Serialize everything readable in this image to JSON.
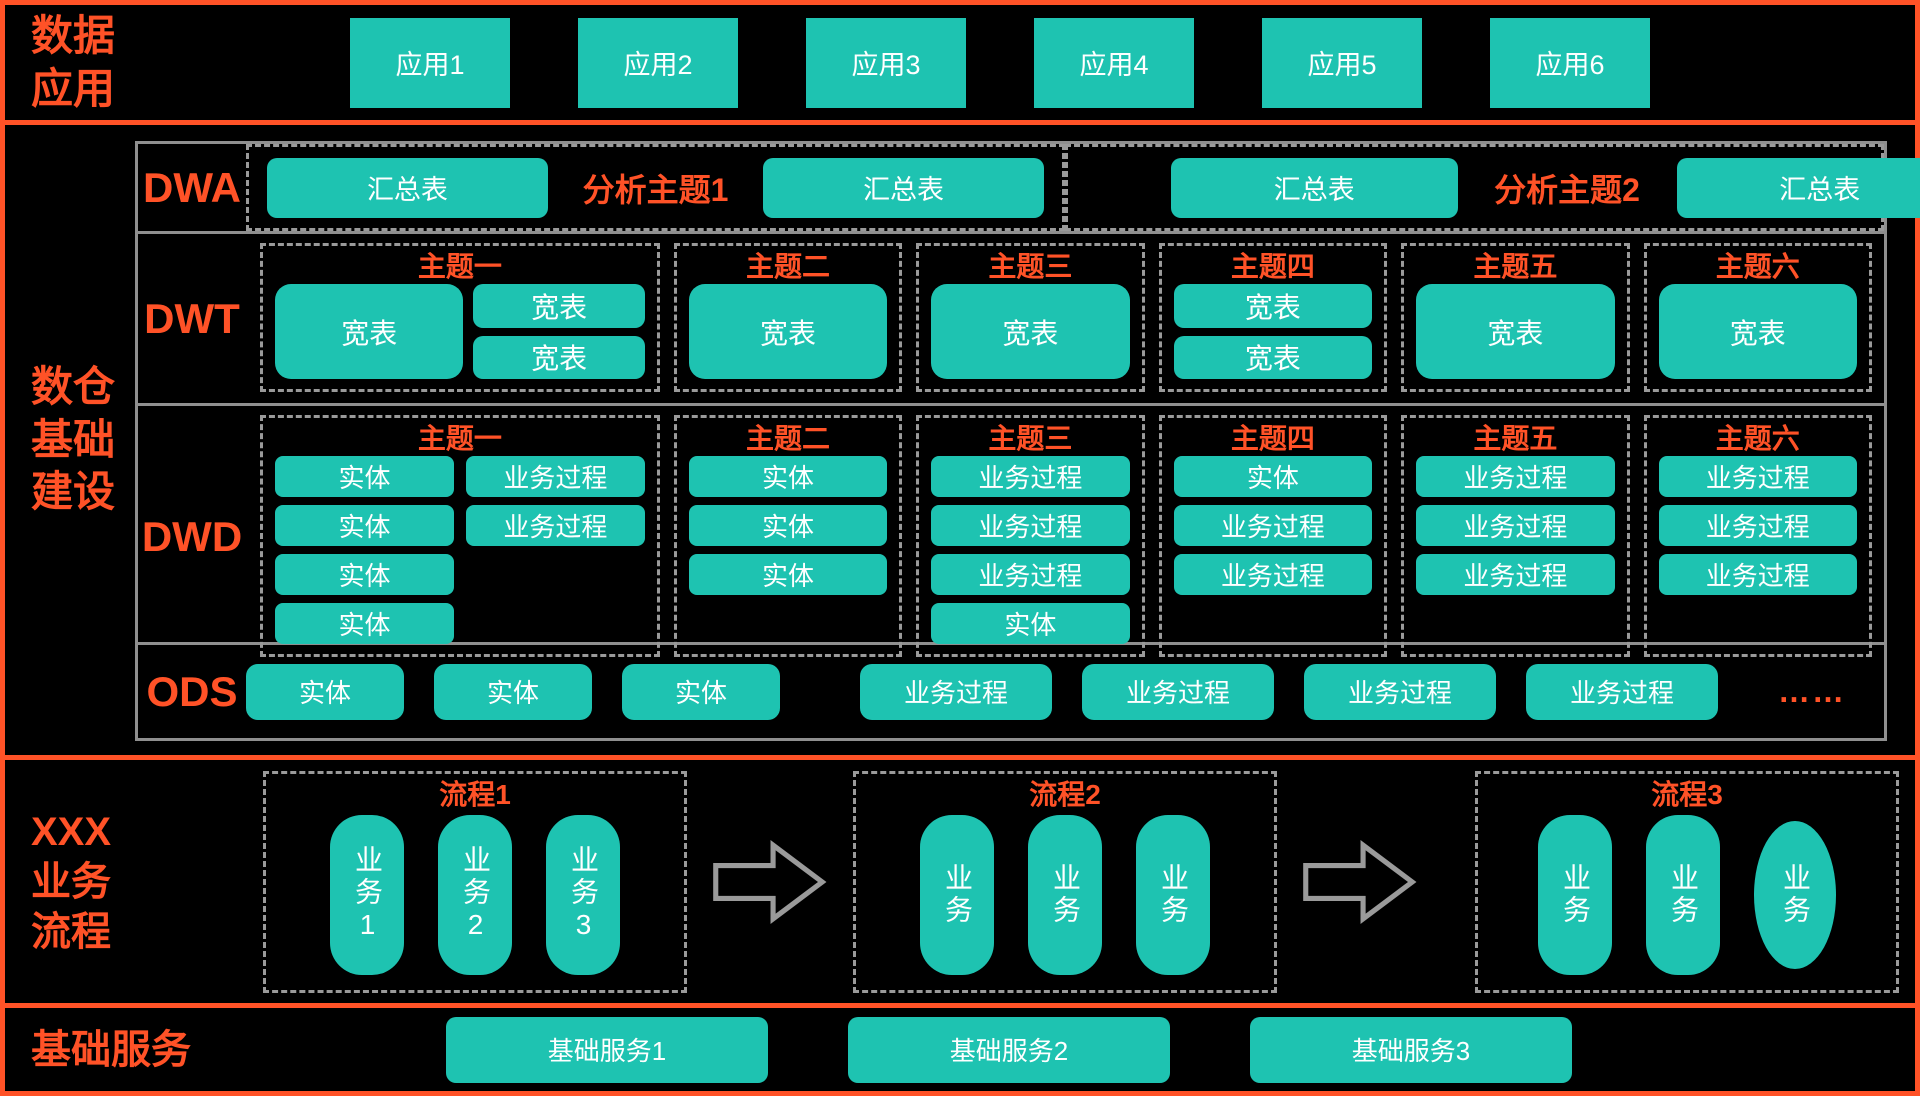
{
  "colors": {
    "accent": "#FF5227",
    "teal": "#1EC3B1",
    "dashed_gray": "#9A9A9A",
    "solid_gray": "#8F8F8F",
    "box_text": "#FFFFFF",
    "background": "#000000"
  },
  "apps_section": {
    "label": "数据\n应用",
    "apps": [
      "应用1",
      "应用2",
      "应用3",
      "应用4",
      "应用5",
      "应用6"
    ]
  },
  "warehouse_section": {
    "label": "数仓\n基础\n建设",
    "dwa": {
      "label": "DWA",
      "groups": [
        {
          "title": "分析主题1",
          "boxes": [
            "汇总表",
            "汇总表"
          ]
        },
        {
          "title": "分析主题2",
          "boxes": [
            "汇总表",
            "汇总表"
          ]
        }
      ]
    },
    "dwt": {
      "label": "DWT",
      "themes": [
        {
          "title": "主题一",
          "big_box": "宽表",
          "stack": [
            "宽表",
            "宽表"
          ]
        },
        {
          "title": "主题二",
          "boxes": [
            "宽表"
          ]
        },
        {
          "title": "主题三",
          "boxes": [
            "宽表"
          ]
        },
        {
          "title": "主题四",
          "boxes": [
            "宽表",
            "宽表"
          ]
        },
        {
          "title": "主题五",
          "boxes": [
            "宽表"
          ]
        },
        {
          "title": "主题六",
          "boxes": [
            "宽表"
          ]
        }
      ]
    },
    "dwd": {
      "label": "DWD",
      "themes": [
        {
          "title": "主题一",
          "col1": [
            "实体",
            "实体",
            "实体",
            "实体"
          ],
          "col2": [
            "业务过程",
            "业务过程"
          ]
        },
        {
          "title": "主题二",
          "boxes": [
            "实体",
            "实体",
            "实体"
          ]
        },
        {
          "title": "主题三",
          "boxes": [
            "业务过程",
            "业务过程",
            "业务过程",
            "实体"
          ]
        },
        {
          "title": "主题四",
          "boxes": [
            "实体",
            "业务过程",
            "业务过程"
          ]
        },
        {
          "title": "主题五",
          "boxes": [
            "业务过程",
            "业务过程",
            "业务过程"
          ]
        },
        {
          "title": "主题六",
          "boxes": [
            "业务过程",
            "业务过程",
            "业务过程"
          ]
        }
      ]
    },
    "ods": {
      "label": "ODS",
      "entity_boxes": [
        "实体",
        "实体",
        "实体"
      ],
      "process_boxes": [
        "业务过程",
        "业务过程",
        "业务过程",
        "业务过程"
      ],
      "ellipsis": "……"
    }
  },
  "flow_section": {
    "label": "XXX\n业务\n流程",
    "flows": [
      {
        "title": "流程1",
        "pills": [
          "业务1",
          "业务2",
          "业务3"
        ]
      },
      {
        "title": "流程2",
        "pills": [
          "业务",
          "业务",
          "业务"
        ]
      },
      {
        "title": "流程3",
        "pills": [
          "业务",
          "业务",
          "业务"
        ]
      }
    ]
  },
  "services_section": {
    "label": "基础服务",
    "services": [
      "基础服务1",
      "基础服务2",
      "基础服务3"
    ]
  }
}
